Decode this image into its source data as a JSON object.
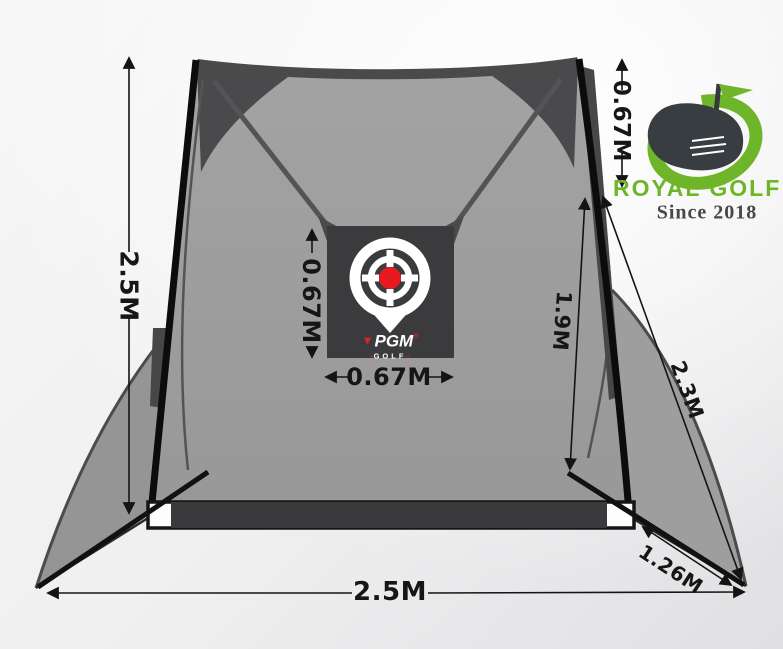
{
  "brand": {
    "name": "ROYAL GOLF",
    "tagline": "Since 2018",
    "green": "#6fb52a"
  },
  "pgm_logo": {
    "name": "PGM",
    "reg": "®",
    "sub": "GOLF"
  },
  "dimensions": {
    "net_height": "2.5M",
    "top_section": "0.67M",
    "target_height": "0.67M",
    "target_width": "0.67M",
    "side_inner": "1.9M",
    "side_slant": "2.3M",
    "wing_depth": "1.26M",
    "base_width": "2.5M"
  },
  "icons": {
    "target": "target-pin-icon",
    "club": "golf-club-icon",
    "flag": "flag-icon",
    "swoosh": "brand-swoosh-icon",
    "pgm_flag": "pgm-flag-icon"
  },
  "colors": {
    "net_gray": "#9c9c9c",
    "panel_dark": "#3b3b3d",
    "target_red": "#e8191f",
    "brand_green": "#6fb52a",
    "frame_black": "#0c0c0c"
  }
}
